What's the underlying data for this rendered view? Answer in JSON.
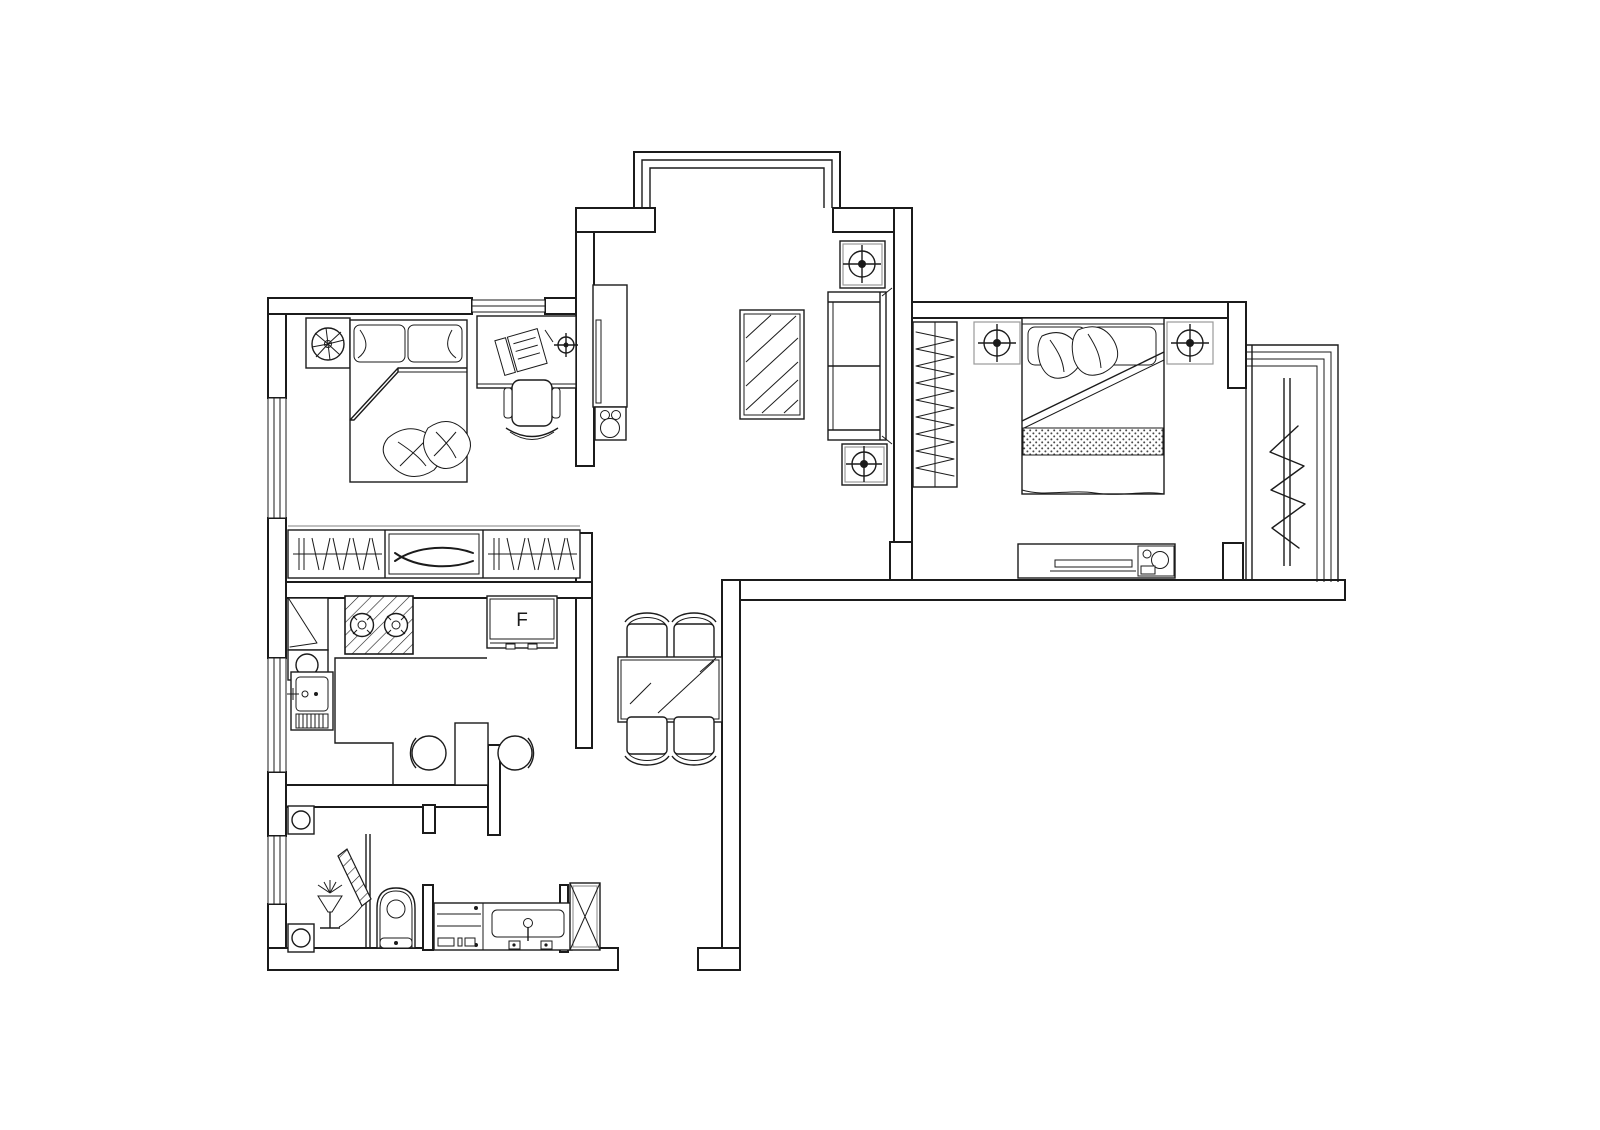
{
  "canvas": {
    "width": 1600,
    "height": 1130,
    "background": "#ffffff",
    "line_color": "#1b1b1b",
    "light_line_color": "#9a9a9a"
  },
  "labels": {
    "fridge": "F"
  }
}
